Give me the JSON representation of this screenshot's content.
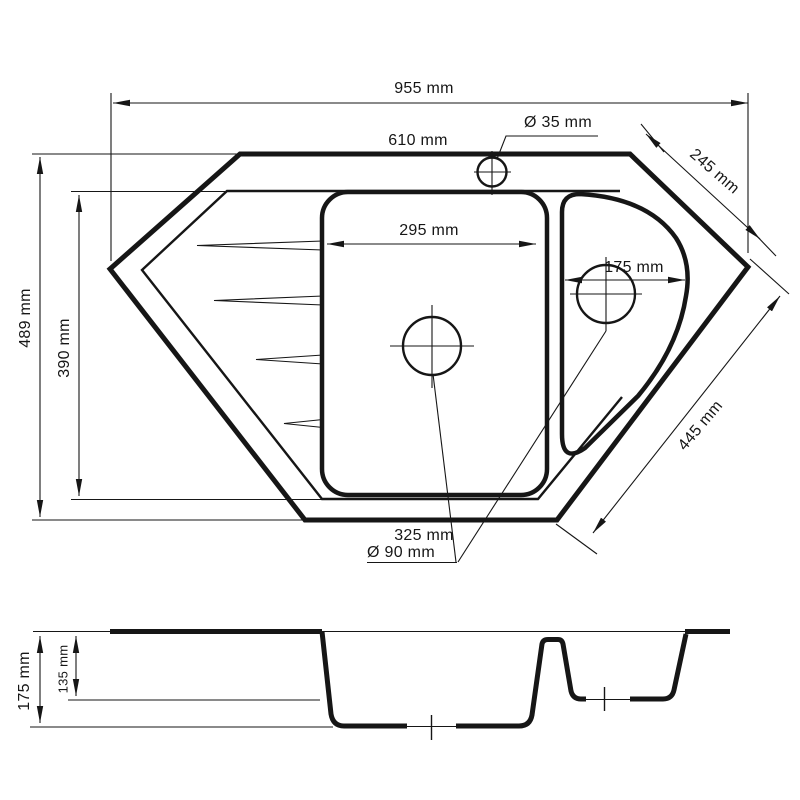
{
  "top_view": {
    "dim_overall_width": "955 mm",
    "dim_top_edge": "610 mm",
    "dim_faucet_hole": "Ø 35 mm",
    "dim_right_top_edge": "245 mm",
    "dim_main_bowl_width": "295 mm",
    "dim_small_bowl_width": "175 mm",
    "dim_overall_depth": "489 mm",
    "dim_inner_depth": "390 mm",
    "dim_right_bottom_edge": "445 mm",
    "dim_bottom_edge": "325 mm",
    "dim_drain_hole": "Ø 90 mm"
  },
  "section_view": {
    "dim_main_bowl_depth": "175 mm",
    "dim_small_bowl_depth": "135 mm"
  },
  "colors": {
    "line": "#161616",
    "background": "#ffffff"
  }
}
